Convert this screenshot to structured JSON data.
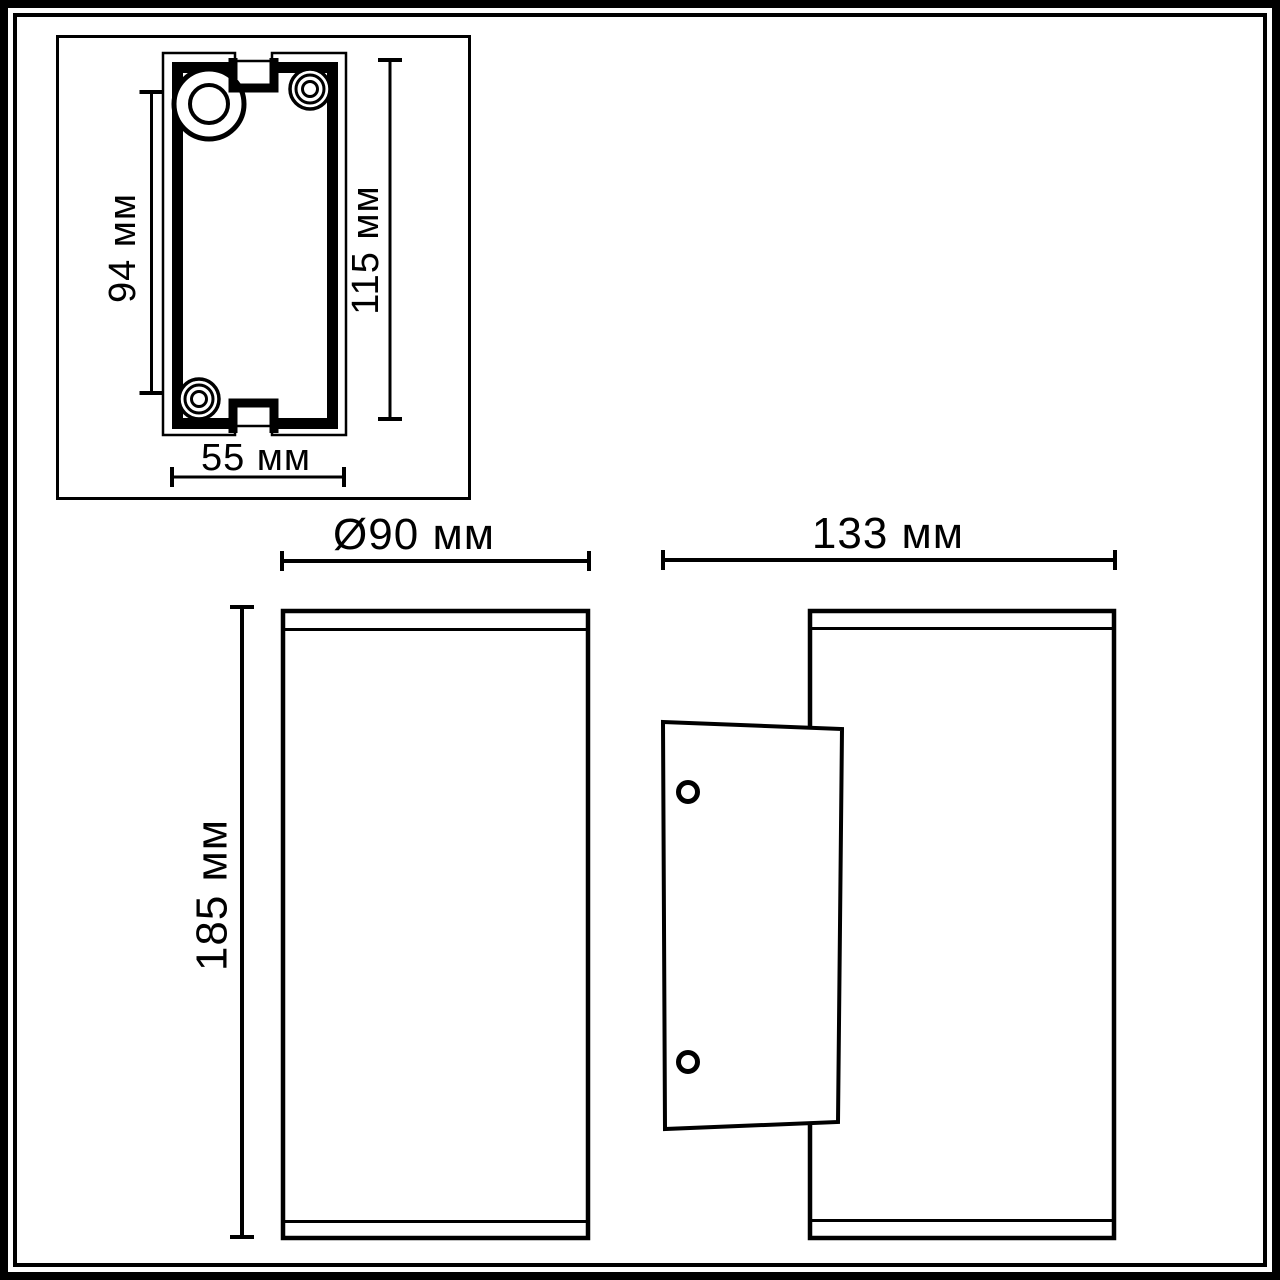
{
  "drawing": {
    "colors": {
      "line": "#000000",
      "background": "#ffffff"
    },
    "views": {
      "inset": {
        "dims": {
          "screw_spacing": "94 мм",
          "plate_height": "115 мм",
          "plate_width": "55 мм"
        }
      },
      "front": {
        "dims": {
          "diameter": "Ø90 мм",
          "body_height": "185 мм"
        }
      },
      "side": {
        "dims": {
          "depth": "133 мм"
        }
      }
    }
  }
}
